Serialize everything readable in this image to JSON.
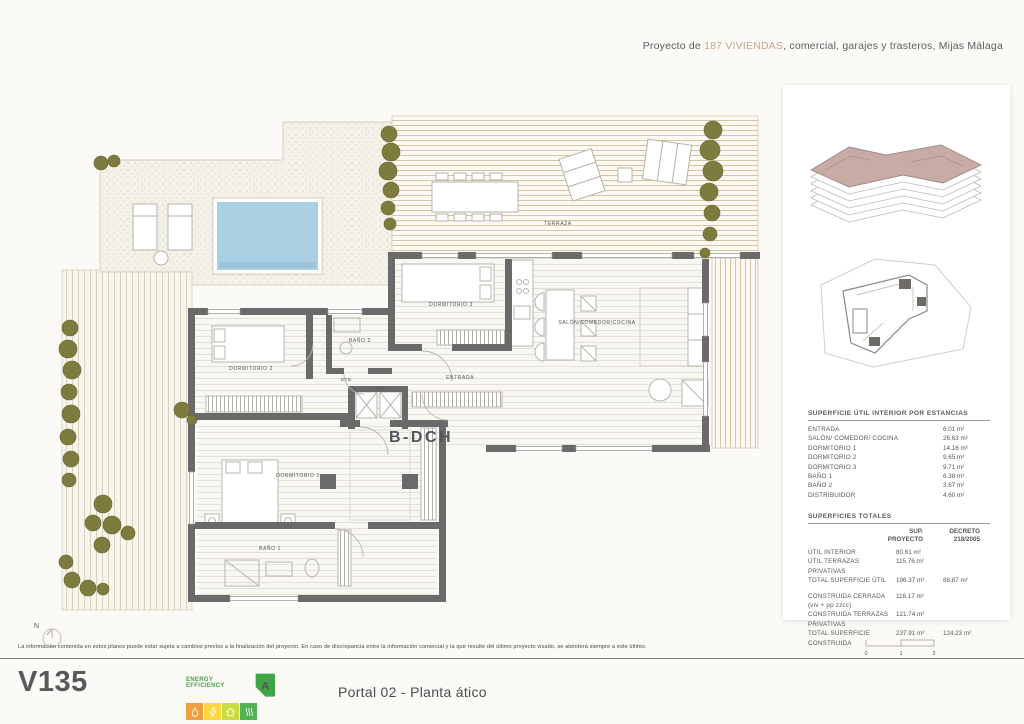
{
  "header": {
    "prefix": "Proyecto de ",
    "highlight": "187 VIVIENDAS",
    "suffix": ", comercial, garajes y trasteros, Mijas Málaga"
  },
  "plan": {
    "unit_label": "B-DCH",
    "compass": "N",
    "labels": {
      "terraza": "TERRAZA",
      "dormitorio3": "DORMITORIO 3",
      "bano2": "BAÑO 2",
      "dormitorio2": "DORMITORIO 2",
      "dtb": "DTB.",
      "core": "CORE",
      "entrada": "ENTRADA",
      "salon": "SALÓN/COMEDOR/COCINA",
      "dormitorio1": "DORMITORIO 1",
      "bano1": "BAÑO 1"
    }
  },
  "panel": {
    "estancias": {
      "title": "SUPERFICIE ÚTIL INTERIOR POR ESTANCIAS",
      "rows": [
        {
          "label": "ENTRADA",
          "value": "6.01 m²"
        },
        {
          "label": "SALÓN/ COMEDOR/ COCINA",
          "value": "26.63 m²"
        },
        {
          "label": "DORMITORIO 1",
          "value": "14.16 m²"
        },
        {
          "label": "DORMITORIO 2",
          "value": "9.65 m²"
        },
        {
          "label": "DORMITORIO 3",
          "value": "9.71 m²"
        },
        {
          "label": "BAÑO 1",
          "value": "6.38 m²"
        },
        {
          "label": "BAÑO 2",
          "value": "3.67 m²"
        },
        {
          "label": "DISTRIBUIDOR",
          "value": "4.60 m²"
        }
      ]
    },
    "totales": {
      "title": "SUPERFICIES TOTALES",
      "col1": "SUP.\nPROYECTO",
      "col2": "DECRETO\n218/2005",
      "rows": [
        {
          "label": "ÚTIL INTERIOR",
          "proyecto": "80.61 m²",
          "decreto": ""
        },
        {
          "label": "ÚTIL TERRAZAS PRIVATIVAS",
          "proyecto": "115.76 m²",
          "decreto": ""
        },
        {
          "label": "TOTAL SUPERFICIE ÚTIL",
          "proyecto": "196.37 m²",
          "decreto": "88.87 m²"
        },
        {
          "label": "CONSTRUIDA CERRADA (viv + pp zzcc)",
          "proyecto": "116.17 m²",
          "decreto": ""
        },
        {
          "label": "CONSTRUIDA TERRAZAS PRIVATIVAS",
          "proyecto": "121.74 m²",
          "decreto": ""
        },
        {
          "label": "TOTAL SUPERFICIE CONSTRUIDA",
          "proyecto": "237.91 m²",
          "decreto": "124.23 m²"
        }
      ]
    },
    "scale": {
      "s0": "0",
      "s1": "1",
      "s2": "2"
    }
  },
  "footer": {
    "disclaimer": "La información contenida en estos planos puede estar sujeta a cambios previos a la finalización del proyecto. En caso de discrepancia entre la información comercial y la que resulte del último proyecto visado, se atenderá siempre a este último.",
    "logo": "V135",
    "energy_title": "ENERGY EFFICIENCY",
    "energy_rating": "A",
    "caption": "Portal 02 - Planta ático"
  },
  "colors": {
    "accent_tan": "#c4a78c",
    "pool_blue": "#a9cfe2",
    "wall_gray": "#6a6a6a",
    "olive_green": "#7e7b3f",
    "energy_green": "#3fa546",
    "building_mauve": "#c8aba5"
  }
}
